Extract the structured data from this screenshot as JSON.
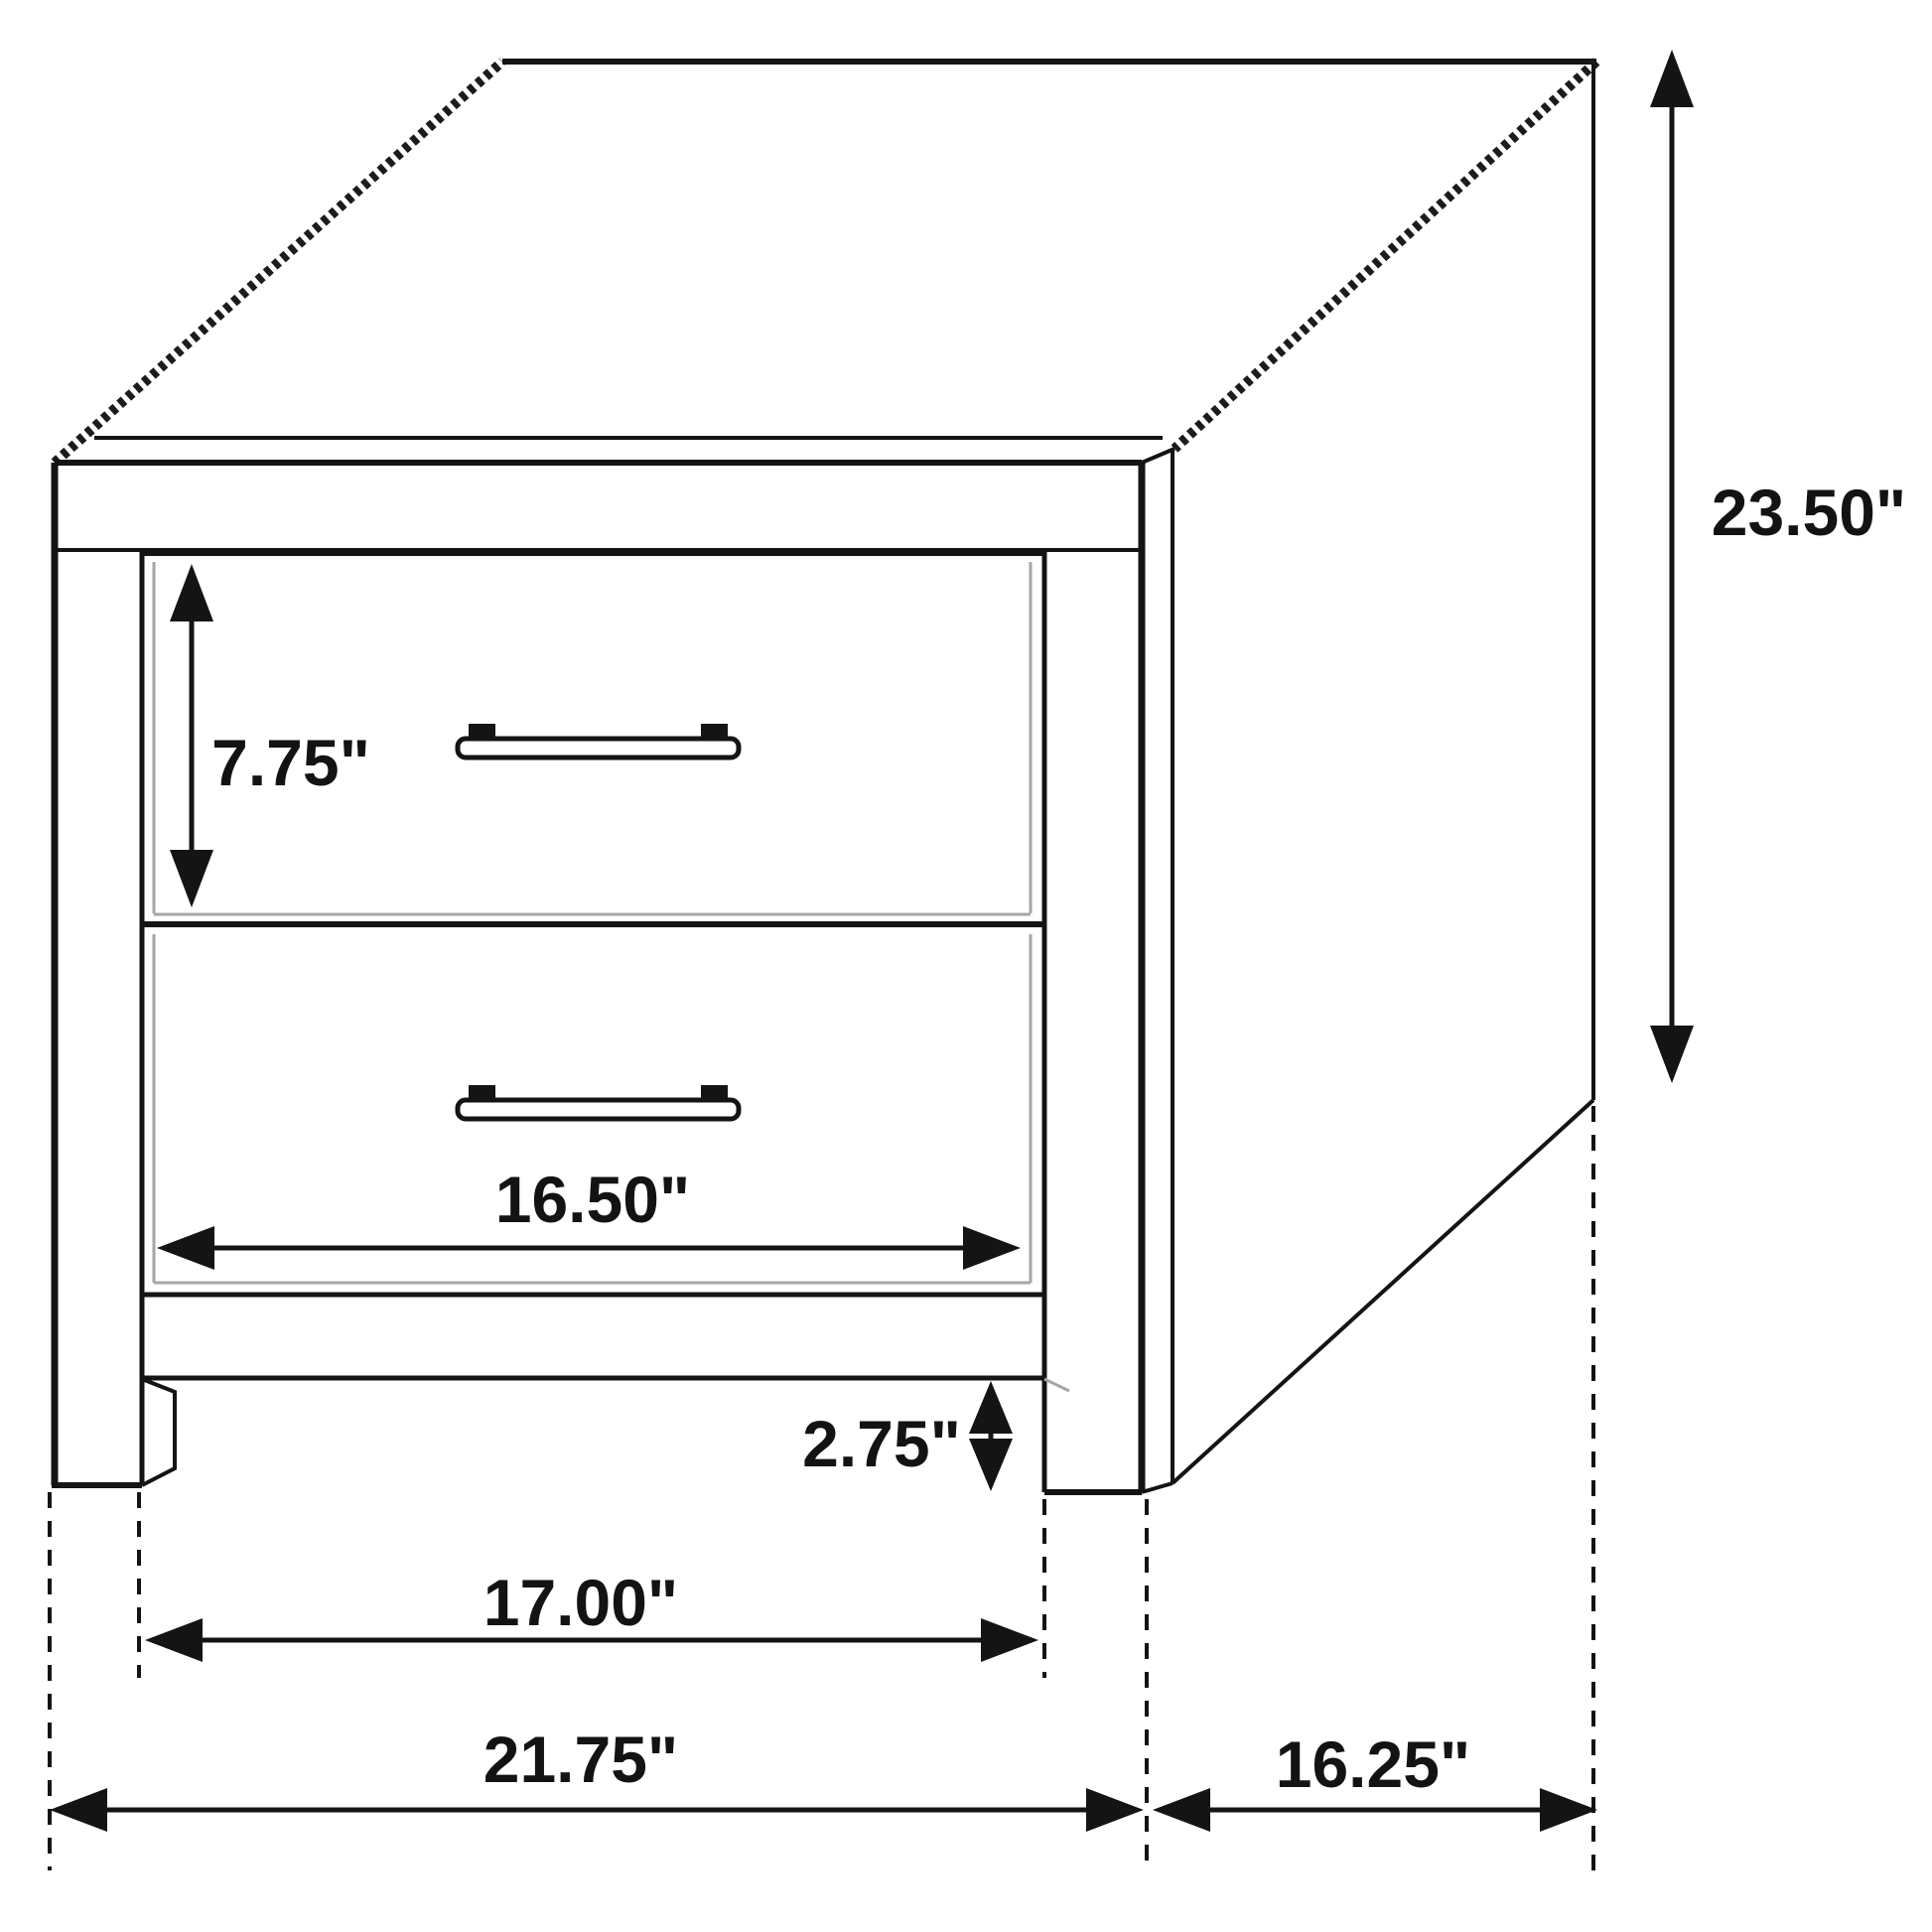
{
  "diagram": {
    "subject": "two-drawer-nightstand",
    "colors": {
      "background": "#ffffff",
      "line": "#141414",
      "shadow": "#a6a6a6"
    },
    "dimensions": {
      "drawer_front_height": "7.75\"",
      "overall_height": "23.50\"",
      "drawer_opening_width": "16.50\"",
      "leg_height": "2.75\"",
      "width_between_legs": "17.00\"",
      "overall_width": "21.75\"",
      "side_depth": "16.25\""
    }
  }
}
